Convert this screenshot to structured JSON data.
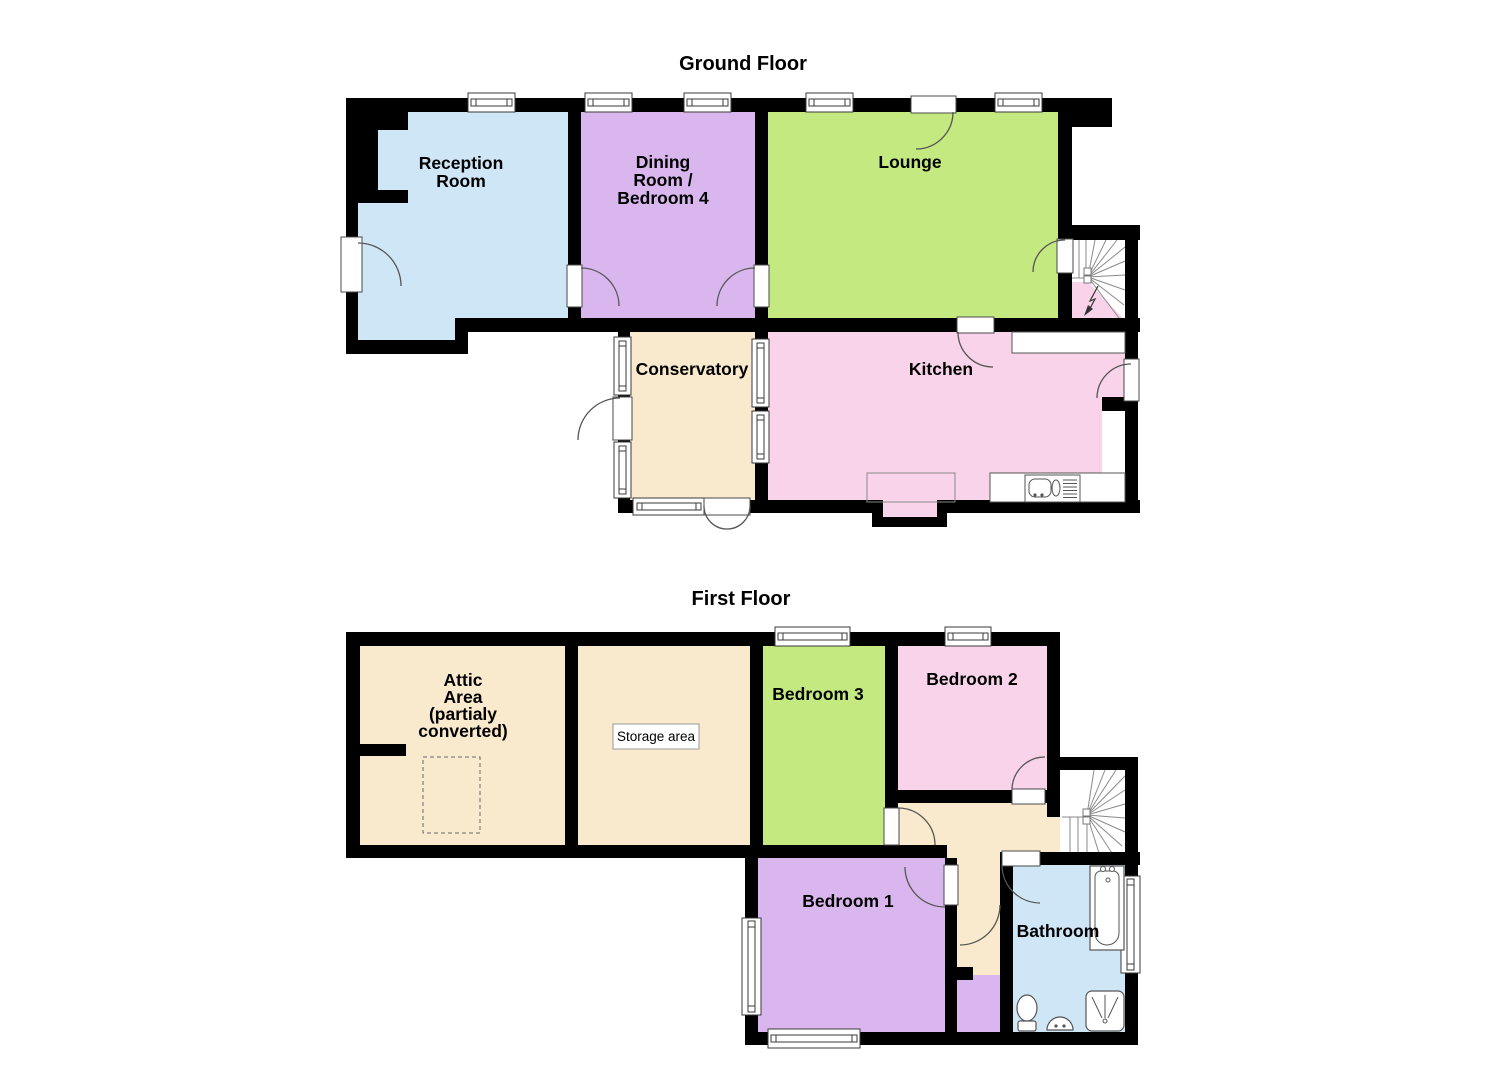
{
  "colors": {
    "wall": "#000000",
    "blue": "#cfe6f7",
    "purple": "#d9b7ee",
    "green": "#c4e981",
    "pink": "#f8d3e9",
    "cream": "#f9e9cd",
    "white": "#ffffff"
  },
  "floors": {
    "ground": {
      "title": "Ground Floor",
      "rooms": {
        "reception": {
          "lines": [
            "Reception",
            "Room"
          ]
        },
        "dining": {
          "lines": [
            "Dining",
            "Room /",
            "Bedroom 4"
          ]
        },
        "lounge": {
          "lines": [
            "Lounge"
          ]
        },
        "conservatory": {
          "lines": [
            "Conservatory"
          ]
        },
        "kitchen": {
          "lines": [
            "Kitchen"
          ]
        }
      }
    },
    "first": {
      "title": "First Floor",
      "rooms": {
        "attic": {
          "lines": [
            "Attic",
            "Area",
            "(partialy",
            "converted)"
          ]
        },
        "storage": {
          "label": "Storage area"
        },
        "bedroom3": {
          "lines": [
            "Bedroom 3"
          ]
        },
        "bedroom2": {
          "lines": [
            "Bedroom 2"
          ]
        },
        "bedroom1": {
          "lines": [
            "Bedroom 1"
          ]
        },
        "bathroom": {
          "lines": [
            "Bathroom"
          ]
        }
      }
    }
  }
}
